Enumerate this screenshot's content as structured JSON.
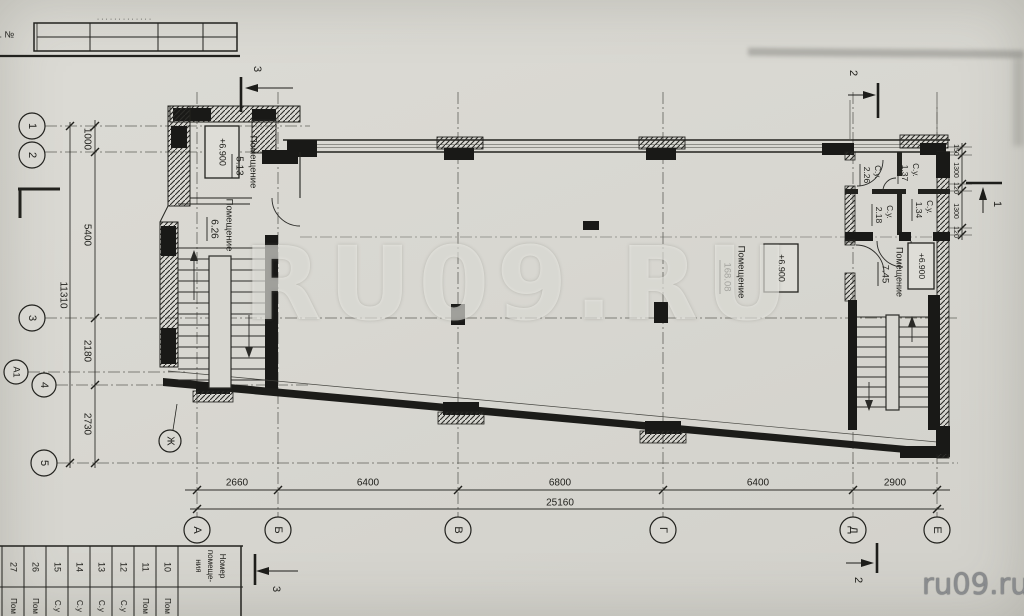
{
  "watermark": {
    "center": "RU09.RU",
    "corner": "ru09.ru"
  },
  "titleblock": {
    "inv_label": "нв. №",
    "dots": "·············"
  },
  "axes": {
    "rows": [
      "1",
      "2",
      "3",
      "А1",
      "4",
      "5"
    ],
    "row_side": "Ж",
    "cols": [
      "А",
      "Б",
      "В",
      "Г",
      "Д",
      "Е"
    ]
  },
  "dims": {
    "left": [
      "1000",
      "5400",
      "2180",
      "2730"
    ],
    "left_total": "11310",
    "bottom": [
      "2660",
      "6400",
      "6800",
      "6400",
      "2900"
    ],
    "bottom_total": "25160",
    "right": [
      "150",
      "1300",
      "120",
      "1300",
      "120"
    ]
  },
  "sections": {
    "cut1": "1",
    "cut2": "2",
    "cut3": "3"
  },
  "rooms": {
    "r513": {
      "title": "Помещение",
      "area": "5.13",
      "elev": "+6.900"
    },
    "r626": {
      "title": "Помещение",
      "area": "6.26"
    },
    "r168": {
      "title": "Помещение",
      "area": "168.08",
      "elev": "+6.900"
    },
    "r745": {
      "title": "Помещение",
      "area": "7.45",
      "elev": "+6.900"
    },
    "su226": {
      "title": "С.у.",
      "area": "2.26"
    },
    "su137": {
      "title": "С.у.",
      "area": "1.37"
    },
    "su218": {
      "title": "С.у.",
      "area": "2.18"
    },
    "su134": {
      "title": "С.у.",
      "area": "1.34"
    }
  },
  "room_table": {
    "header_lines": [
      "Номер",
      "помеще-",
      "ния"
    ],
    "numbers": [
      "27",
      "26",
      "15",
      "14",
      "13",
      "12",
      "11",
      "10"
    ],
    "names": [
      "Пом",
      "Пом",
      "С.у",
      "С.у",
      "С.у",
      "С.у",
      "Пом",
      "Пом"
    ]
  }
}
